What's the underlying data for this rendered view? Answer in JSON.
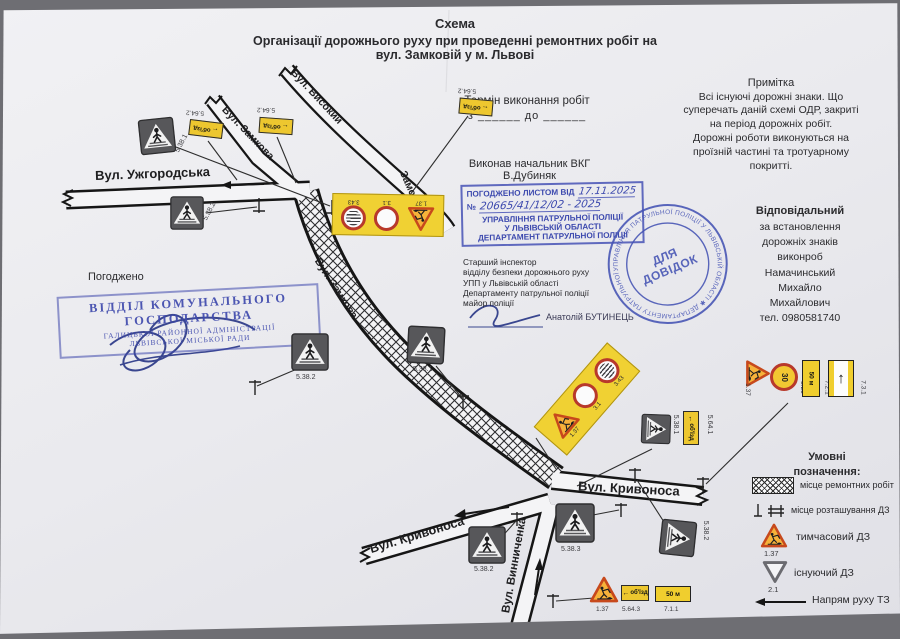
{
  "title": {
    "line1": "Схема",
    "line2": "Організації дорожнього руху при проведенні ремонтних робіт на",
    "line3": "вул. Замковій у м. Львові"
  },
  "term": {
    "heading": "Термін виконання робіт",
    "range": "з ______  до ______"
  },
  "note": {
    "heading": "Примітка",
    "lines": [
      "Всі існуючі дорожні знаки. Що",
      "суперечать даній схемі ОДР, закриті",
      "на період дорожніх робіт.",
      "Дорожні роботи виконуються на",
      "проїзній частині та тротуарному",
      "покритті."
    ]
  },
  "executor": {
    "line1": "Виконав начальник ВКГ",
    "line2": "В.Дубиняк"
  },
  "approval": {
    "heading": "ПОГОДЖЕНО ЛИСТОМ ВІД",
    "date": "17.11.2025",
    "no_prefix": "№",
    "number": "20665/41/12/02 - 2025",
    "org1": "УПРАВЛІННЯ ПАТРУЛЬНОЇ ПОЛІЦІЇ",
    "org2": "У ЛЬВІВСЬКІЙ ОБЛАСТІ",
    "org3": "ДЕПАРТАМЕНТ ПАТРУЛЬНОЇ ПОЛІЦІЇ"
  },
  "inspector": {
    "lines": [
      "Старший інспектор",
      "відділу безпеки дорожнього руху",
      "УПП у Львівській області",
      "Департаменту патрульної поліції",
      "майор поліції"
    ],
    "name": "Анатолій БУТИНЕЦЬ"
  },
  "round_stamp": {
    "ring": "УПРАВЛІННЯ ПАТРУЛЬНОЇ ПОЛІЦІЇ У ЛЬВІВСЬКІЙ ОБЛАСТІ ✱ ДЕПАРТАМЕНТУ ПАТРУЛЬНОЇ ПОЛІЦІЇ ✱",
    "center1": "ДЛЯ",
    "center2": "ДОВІДОК"
  },
  "responsible": {
    "lines": [
      "Відповідальний",
      "за встановлення",
      "дорожніх знаків",
      "виконроб",
      "Намачинський",
      "Михайло",
      "Михайлович",
      "тел. 0980581740"
    ]
  },
  "agreed_label": "Погоджено",
  "dept_stamp": {
    "lines": [
      "ВІДДІЛ КОМУНАЛЬНОГО",
      "ГОСПОДАРСТВА",
      "ГАЛИЦЬКОЇ РАЙОННОЇ АДМІНІСТРАЦІЇ",
      "ЛЬВІВСЬКОЇ МІСЬКОЇ РАДИ"
    ]
  },
  "streets": {
    "uzhhorodska": "Вул. Ужгородська",
    "zamkova_top": "Вул. Замкова",
    "vysokyi1": "Вул. Високий",
    "vysokyi2": "Замок",
    "zamkova_repair": "Вул. Замкова",
    "kryvonosa_right": "Вул. Кривоноса",
    "kryvonosa_left": "Вул. Кривоноса",
    "vynnychenka": "Вул. Винниченка"
  },
  "legend": {
    "heading1": "Умовні",
    "heading2": "позначення:",
    "items": [
      {
        "label": "місце ремонтних робіт"
      },
      {
        "label": "місце розташування ДЗ"
      },
      {
        "label": "тимчасовий ДЗ",
        "code": "1.37"
      },
      {
        "label": "існуючий ДЗ",
        "code": "2.1"
      },
      {
        "label": "Напрям руху ТЗ"
      }
    ]
  },
  "map_signs": {
    "tl_ped": "5.38.1",
    "ml_ped": "5.38.2",
    "det1": "5.64.2",
    "det2": "5.64.2",
    "det3": "5.64.2",
    "panelA": [
      "3.43",
      "3.1",
      "1.37"
    ],
    "hatch_left_ped": "5.38.2",
    "hatch_right_ped": "5.38.1",
    "panelB": [
      "1.37",
      "3.1",
      "3.43"
    ],
    "pair_ped": "5.38.1",
    "pair_det": "5.64.1",
    "grp_tri": "1.37",
    "grp_speed": "3.29",
    "grp_dist": "7.2.1",
    "grp_lane": "7.3.1",
    "kr_ped": "5.38.3",
    "kr_ped2": "5.38.2",
    "kl_ped": "5.38.2",
    "bot_tri": "1.37",
    "bot_det": "5.64.3",
    "bot_dist": "7.1.1"
  },
  "signs_text": {
    "detour": "об'їзд",
    "speed": "30",
    "distance": "50 м"
  },
  "icons": {
    "left_arrow": "←",
    "up_arrow": "↑"
  }
}
